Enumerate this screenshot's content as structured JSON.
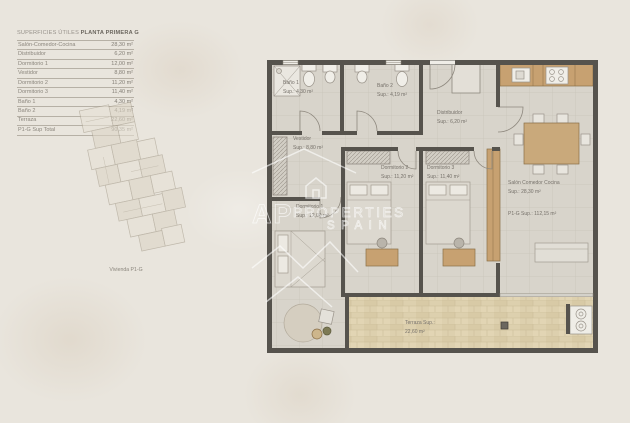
{
  "areas_table": {
    "header_left": "SUPERFICIES ÚTILES",
    "header_right": "PLANTA PRIMERA G",
    "rows": [
      {
        "label": "Salón-Comedor-Cocina",
        "value": "28,30 m²"
      },
      {
        "label": "Distribuidor",
        "value": "6,20 m²"
      },
      {
        "label": "Dormitorio 1",
        "value": "12,00 m²"
      },
      {
        "label": "Vestidor",
        "value": "8,80 m²"
      },
      {
        "label": "Dormitorio 2",
        "value": "11,20 m²"
      },
      {
        "label": "Dormitorio 3",
        "value": "11,40 m²"
      },
      {
        "label": "Baño 1",
        "value": "4,30 m²"
      },
      {
        "label": "Baño 2",
        "value": "4,19 m²"
      },
      {
        "label": "Terraza",
        "value": "22,60 m²"
      },
      {
        "label": "P1-G Sup Total",
        "value": "90,35 m²"
      }
    ]
  },
  "overview_caption": "Vivienda P1-G",
  "plan_labels": {
    "bano1": {
      "name": "Baño 1",
      "sup": "Sup.: 4,30 m²"
    },
    "bano2": {
      "name": "Baño 2",
      "sup": "Sup.: 4,19 m²"
    },
    "distribuidor": {
      "name": "Distribuidor",
      "sup": "Sup.: 6,20 m²"
    },
    "vestidor": {
      "name": "Vestidor",
      "sup": "Sup.: 8,80 m²"
    },
    "dormitorio1": {
      "name": "Dormitorio 1",
      "sup": "Sup.: 12,00 m²"
    },
    "dormitorio2": {
      "name": "Dormitorio 2",
      "sup": "Sup.: 11,20 m²"
    },
    "dormitorio3": {
      "name": "Dormitorio 3",
      "sup": "Sup.: 11,40 m²"
    },
    "salon": {
      "name": "Salón Comedor Cocina",
      "sup": "Sup.: 28,30 m²"
    },
    "terraza": {
      "name": "Terraza Sup.:",
      "sup": "22,60 m²"
    },
    "total": "P1-G Sup.: 112,15 m²"
  },
  "watermark": {
    "initials": "AP",
    "word1": "PROPERTIES",
    "word2": "SPAIN"
  },
  "colors": {
    "wall": "#56534d",
    "floor": "#d8d4cb",
    "terrace": "#decfad",
    "wood": "#c7a171",
    "background": "#e9e5dd"
  }
}
